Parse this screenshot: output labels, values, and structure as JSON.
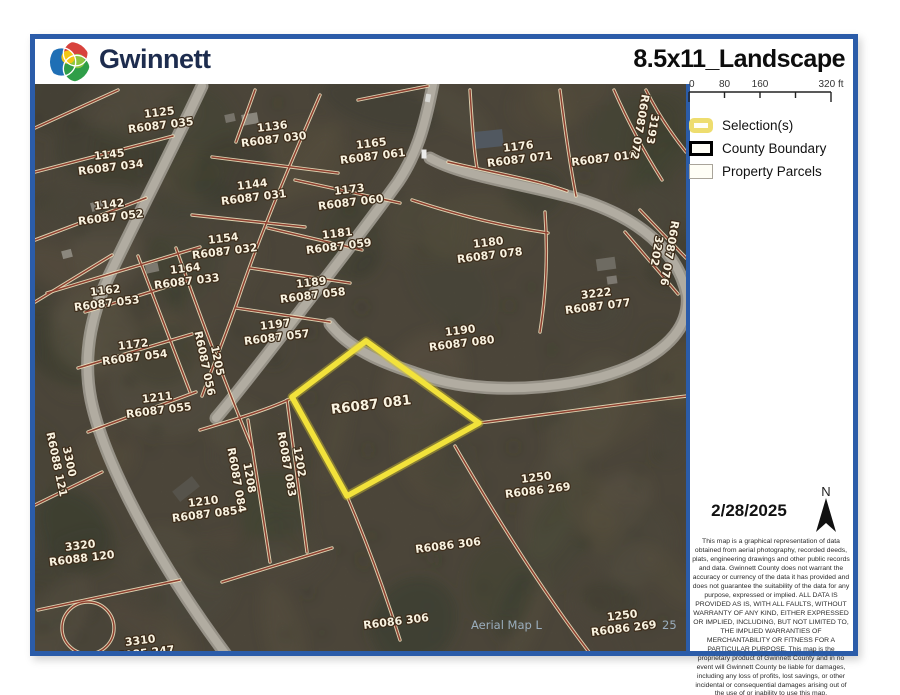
{
  "header": {
    "logo_text": "Gwinnett",
    "title": "8.5x11_Landscape"
  },
  "panel": {
    "scalebar": {
      "unit": "ft",
      "max_ft": 320,
      "ticks": [
        {
          "label": "0",
          "ft": 0
        },
        {
          "label": "80",
          "ft": 80
        },
        {
          "label": "160",
          "ft": 160
        },
        {
          "label": "",
          "ft": 240
        },
        {
          "label": "320 ft",
          "ft": 320
        }
      ]
    },
    "legend": {
      "items": [
        {
          "label": "Selection(s)",
          "swatch": "selection"
        },
        {
          "label": "County Boundary",
          "swatch": "county"
        },
        {
          "label": "Property Parcels",
          "swatch": "parcels"
        }
      ]
    },
    "date": "2/28/2025",
    "north_label": "N",
    "disclaimer": "This map is a graphical representation of data obtained from aerial photography, recorded deeds, plats, engineering drawings and other public records and data.  Gwinnett County does not warrant the accuracy or currency of the data it has provided and does not guarantee the suitability of the data for any purpose, expressed or implied.  ALL DATA IS PROVIDED AS IS, WITH ALL FAULTS, WITHOUT WARRANTY OF ANY KIND, EITHER EXPRESSED OR IMPLIED, INCLUDING, BUT NOT LIMITED TO, THE IMPLIED WARRANTIES OF MERCHANTABILITY OR FITNESS FOR A PARTICULAR PURPOSE.  This map is the proprietary product of Gwinnett County and in no event will Gwinnett County be liable for damages, including any loss of profits, lost savings, or other incidental or consequential damages arising out of the use of or inability to use this map."
  },
  "map": {
    "colors": {
      "parcel_line": "#8f4030",
      "parcel_halo": "#ece0bd",
      "selection": "#f2e23b",
      "selection_glow": "#cdbc2e",
      "label_fill": "#f8f2e0",
      "label_outline": "#3d2c1a",
      "road": "#9b978c",
      "road_center": "#b6b2a6",
      "watermark": "#a9c0d4"
    },
    "selection": {
      "parcel_id": "R6087 081",
      "points": [
        [
          366,
          341
        ],
        [
          292,
          397
        ],
        [
          347,
          496
        ],
        [
          479,
          423
        ]
      ]
    },
    "labels": [
      {
        "lines": [
          "1125",
          "R6087 035"
        ],
        "x": 160,
        "y": 119
      },
      {
        "lines": [
          "1136",
          "R6087 030"
        ],
        "x": 273,
        "y": 133
      },
      {
        "lines": [
          "1165",
          "R6087 061"
        ],
        "x": 372,
        "y": 150
      },
      {
        "lines": [
          "1176",
          "R6087 071"
        ],
        "x": 519,
        "y": 153
      },
      {
        "lines": [
          "R6087 019"
        ],
        "x": 604,
        "y": 158
      },
      {
        "lines": [
          "3193",
          "R6087 072"
        ],
        "x": 646,
        "y": 128,
        "rot": 100
      },
      {
        "lines": [
          "1145",
          "R6087 034"
        ],
        "x": 110,
        "y": 161
      },
      {
        "lines": [
          "1144",
          "R6087 031"
        ],
        "x": 253,
        "y": 191
      },
      {
        "lines": [
          "1173",
          "R6087 060"
        ],
        "x": 350,
        "y": 196
      },
      {
        "lines": [
          "1142",
          "R6087 052"
        ],
        "x": 110,
        "y": 211
      },
      {
        "lines": [
          "1154",
          "R6087 032"
        ],
        "x": 224,
        "y": 245
      },
      {
        "lines": [
          "1181",
          "R6087 059"
        ],
        "x": 338,
        "y": 240
      },
      {
        "lines": [
          "1164",
          "R6087 033"
        ],
        "x": 186,
        "y": 275
      },
      {
        "lines": [
          "1180",
          "R6087 078"
        ],
        "x": 489,
        "y": 249
      },
      {
        "lines": [
          "1162",
          "R6087 053"
        ],
        "x": 106,
        "y": 297
      },
      {
        "lines": [
          "1189",
          "R6087 058"
        ],
        "x": 312,
        "y": 289
      },
      {
        "lines": [
          "3222",
          "R6087 077"
        ],
        "x": 597,
        "y": 300
      },
      {
        "lines": [
          "1172",
          "R6087 054"
        ],
        "x": 134,
        "y": 351
      },
      {
        "lines": [
          "1197",
          "R6087 057"
        ],
        "x": 276,
        "y": 331
      },
      {
        "lines": [
          "1190",
          "R6087 080"
        ],
        "x": 461,
        "y": 337
      },
      {
        "lines": [
          "1205",
          "R6087 056"
        ],
        "x": 211,
        "y": 362,
        "rot": 78
      },
      {
        "lines": [
          "R6087 081"
        ],
        "x": 371,
        "y": 404,
        "big": true
      },
      {
        "lines": [
          "1211",
          "R6087 055"
        ],
        "x": 158,
        "y": 404
      },
      {
        "lines": [
          "1250",
          "R6086 269"
        ],
        "x": 537,
        "y": 484
      },
      {
        "lines": [
          "1202",
          "R6087 083"
        ],
        "x": 293,
        "y": 463,
        "rot": 80
      },
      {
        "lines": [
          "1208",
          "R6087 084"
        ],
        "x": 243,
        "y": 479,
        "rot": 80
      },
      {
        "lines": [
          "3300",
          "R6088 121"
        ],
        "x": 63,
        "y": 463,
        "rot": 78
      },
      {
        "lines": [
          "1210",
          "R6087 085"
        ],
        "x": 204,
        "y": 508
      },
      {
        "lines": [
          "3320",
          "R6088 120"
        ],
        "x": 81,
        "y": 552
      },
      {
        "lines": [
          "R6086 306"
        ],
        "x": 448,
        "y": 545
      },
      {
        "lines": [
          "R6086 306"
        ],
        "x": 396,
        "y": 621
      },
      {
        "lines": [
          "1250",
          "R6086 269"
        ],
        "x": 623,
        "y": 622
      },
      {
        "lines": [
          "3310",
          "R6085 247"
        ],
        "x": 141,
        "y": 647
      },
      {
        "lines": [
          "R6087 076",
          "3202"
        ],
        "x": 663,
        "y": 252,
        "rot": 100
      }
    ],
    "watermarks": [
      {
        "text": "Aerial Map L",
        "x": 471,
        "y": 629
      },
      {
        "text": "25",
        "x": 662,
        "y": 629
      }
    ],
    "roads": [
      "M 433,84 C 424,130 416,155 398,182 C 372,218 340,260 305,305 C 272,348 240,390 216,418",
      "M 430,158 C 462,176 520,183 575,198 C 640,217 678,252 687,295 C 691,333 655,362 600,377 C 540,392 475,392 427,377 C 389,365 352,352 330,324",
      "M 202,86 C 172,150 138,215 108,278 C 89,320 83,360 91,400 C 103,458 152,556 230,660"
    ],
    "parcel_lines": [
      "M 35,128 L 118,90",
      "M 35,172 L 173,136",
      "M 35,240 L 146,198",
      "M 35,302 L 112,255",
      "M 47,293 L 200,247",
      "M 85,312 L 186,281",
      "M 78,368 L 192,334",
      "M 88,432 L 196,392",
      "M 138,256 L 190,392",
      "M 176,248 C 205,330 230,395 252,448",
      "M 192,215 L 305,227",
      "M 212,157 L 338,173",
      "M 255,90 C 248,110 242,125 236,142",
      "M 295,180 L 400,203",
      "M 268,228 L 362,250",
      "M 250,268 L 350,283",
      "M 236,308 L 330,322",
      "M 320,95 C 292,160 265,222 242,288 C 228,330 212,368 202,396",
      "M 358,100 L 428,86",
      "M 470,90 C 472,125 474,150 477,168",
      "M 448,162 C 500,174 540,181 567,191",
      "M 412,200 C 460,216 508,227 548,233",
      "M 560,90 C 565,130 570,165 576,196",
      "M 614,90 C 628,122 643,150 662,180",
      "M 646,90 C 657,112 670,132 686,152",
      "M 640,210 L 686,258",
      "M 625,232 L 678,294",
      "M 545,212 C 548,255 546,295 540,332",
      "M 479,423 C 550,414 620,404 687,396",
      "M 455,446 C 495,515 545,595 592,656",
      "M 347,496 C 368,545 385,592 400,640",
      "M 200,430 C 240,418 272,408 292,398",
      "M 248,420 L 270,562",
      "M 287,400 L 307,552",
      "M 222,582 L 332,548",
      "M 35,505 L 102,472",
      "M 38,610 L 180,580",
      "M 62,628 a 26,26 0 1 0 52,0 a 26,26 0 1 0 -52,0"
    ]
  }
}
